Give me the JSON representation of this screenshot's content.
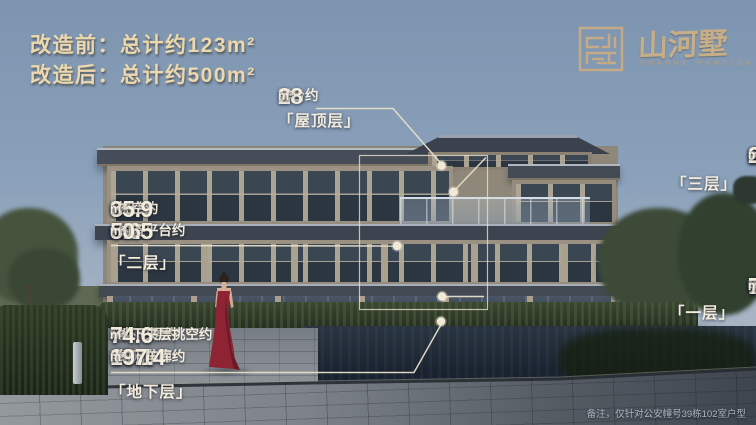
{
  "header": {
    "line_before": "改造前：总计约123m²",
    "line_after": "改造后：总计约500m²"
  },
  "logo": {
    "seal_character": "墅",
    "brand_name": "山河墅",
    "brand_subtitle": "SHANHE MANSION"
  },
  "annotations": {
    "roof_level": {
      "lines": [
        [
          {
            "t": "露台约",
            "c": "zh"
          },
          {
            "t": "28",
            "c": "num"
          },
          {
            "t": "m²",
            "c": "unit"
          }
        ]
      ],
      "label": "「屋顶层」"
    },
    "third_floor": {
      "lines": [
        [
          {
            "t": "露台约",
            "c": "zh"
          },
          {
            "t": "26.3",
            "c": "num"
          },
          {
            "t": "m²",
            "c": "unit"
          },
          {
            "t": "+阳台约",
            "c": "zh"
          },
          {
            "t": "2.1",
            "c": "num"
          },
          {
            "t": "m²",
            "c": "unit"
          },
          {
            "t": "=约",
            "c": "zh"
          },
          {
            "t": "28.4",
            "c": "num"
          },
          {
            "t": "m²",
            "c": "unit"
          }
        ]
      ],
      "label": "「三层」"
    },
    "second_floor": {
      "lines": [
        [
          {
            "t": "露台约",
            "c": "zh"
          },
          {
            "t": "9",
            "c": "num"
          },
          {
            "t": "m²",
            "c": "unit"
          },
          {
            "t": "+挑空约",
            "c": "zh"
          },
          {
            "t": "35.9",
            "c": "num"
          },
          {
            "t": "m²",
            "c": "unit"
          }
        ],
        [
          {
            "t": "+设备平台约",
            "c": "zh"
          },
          {
            "t": "5.6",
            "c": "num"
          },
          {
            "t": "m²",
            "c": "unit"
          },
          {
            "t": "=约",
            "c": "zh"
          },
          {
            "t": "50.5",
            "c": "num"
          },
          {
            "t": "m²",
            "c": "unit"
          }
        ]
      ],
      "label": "「二层」"
    },
    "first_floor": {
      "lines": [
        [
          {
            "t": "前后花园约",
            "c": "zh"
          },
          {
            "t": "76",
            "c": "num"
          },
          {
            "t": "m²",
            "c": "unit"
          },
          {
            "t": "+飘窗约",
            "c": "zh"
          },
          {
            "t": "1.4",
            "c": "num"
          },
          {
            "t": "m²",
            "c": "unit"
          },
          {
            "t": "=约",
            "c": "zh"
          },
          {
            "t": "77.4",
            "c": "num"
          },
          {
            "t": "m²",
            "c": "unit"
          }
        ]
      ],
      "label": "「一层」"
    },
    "basement": {
      "lines": [
        [
          {
            "t": "地下一层约",
            "c": "zh"
          },
          {
            "t": "74.6",
            "c": "num"
          },
          {
            "t": "m²",
            "c": "unit"
          },
          {
            "t": "+地下夹层挑空约",
            "c": "zh"
          },
          {
            "t": "74.6",
            "c": "num"
          },
          {
            "t": "m²",
            "c": "unit"
          }
        ],
        [
          {
            "t": "+采光井约",
            "c": "zh"
          },
          {
            "t": "10.1",
            "c": "num"
          },
          {
            "t": "m²",
            "c": "unit"
          },
          {
            "t": "+地下车库约",
            "c": "zh"
          },
          {
            "t": "38.1",
            "c": "num"
          },
          {
            "t": "m²",
            "c": "unit"
          },
          {
            "t": "=约",
            "c": "zh"
          },
          {
            "t": "197.4",
            "c": "num"
          },
          {
            "t": "m²",
            "c": "unit"
          }
        ]
      ],
      "label": "「地下层」"
    }
  },
  "footnote": "备注，仅针对公安幢号39栋102室户型",
  "colors": {
    "headline_text": "#ECD8AC",
    "annotation_text": "#F3ECDD",
    "leader_line": "#E8DFC9",
    "brand_gold": "#C6AE88",
    "dress_red": "#8E2433"
  }
}
